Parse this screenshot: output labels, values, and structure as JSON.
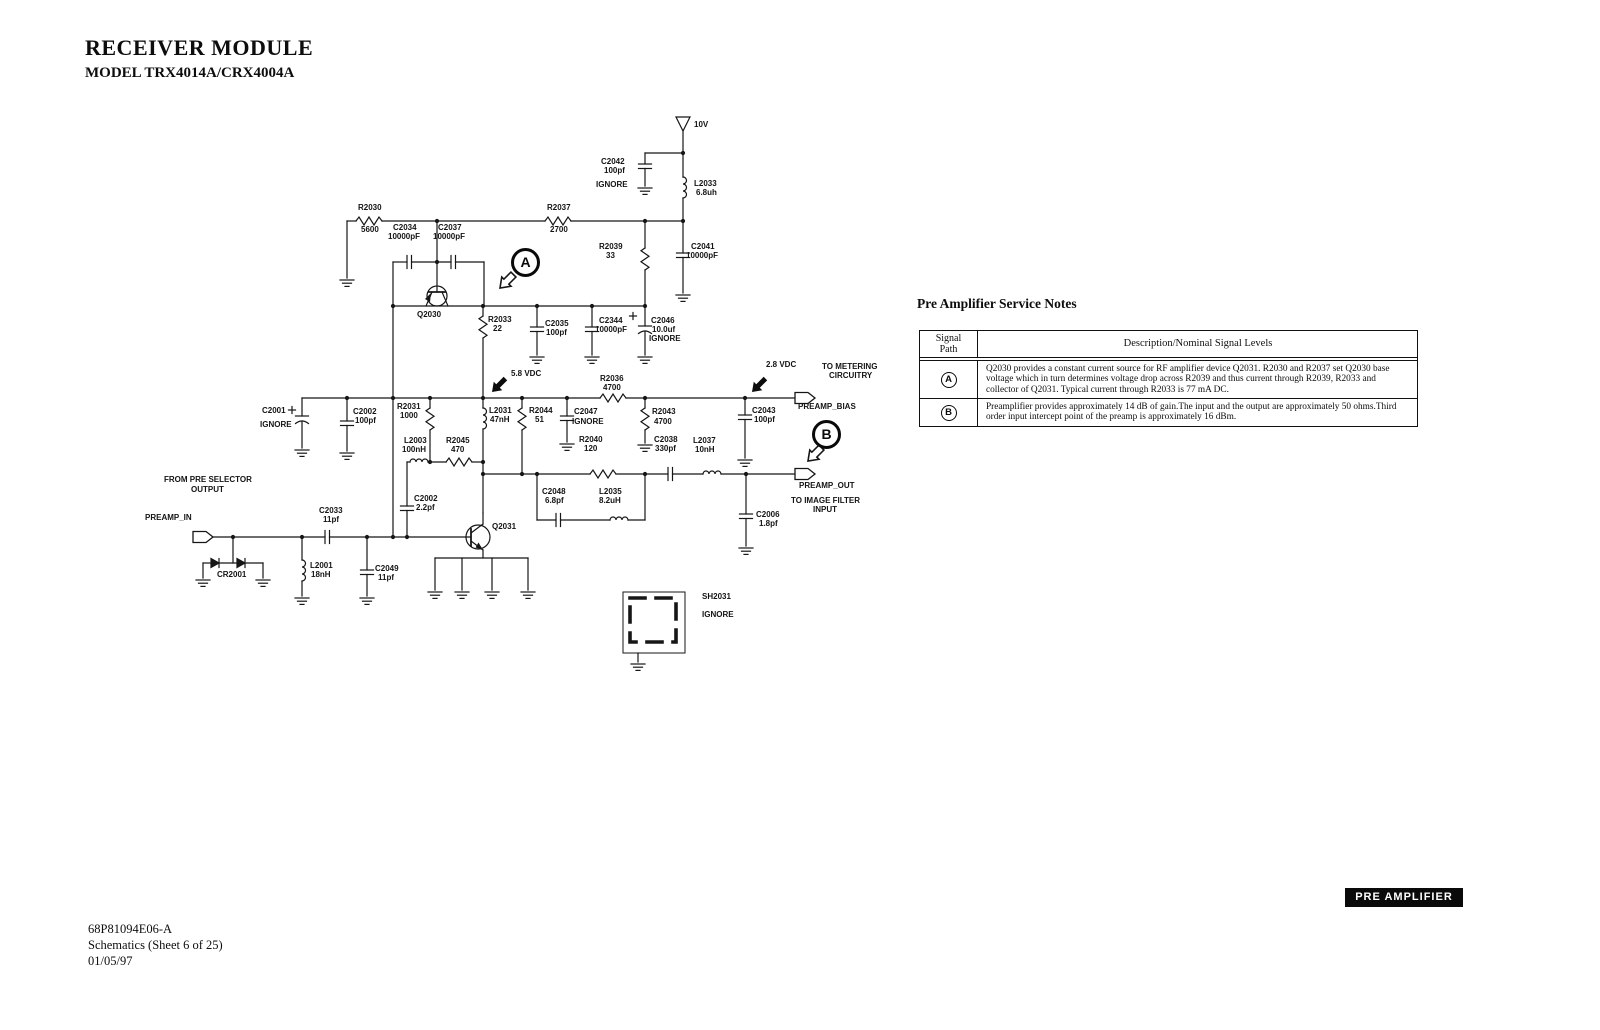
{
  "header": {
    "title": "RECEIVER MODULE",
    "model": "MODEL TRX4014A/CRX4004A"
  },
  "footer": {
    "part_number": "68P81094E06-A",
    "sheet": "Schematics (Sheet 6 of 25)",
    "date": "01/05/97"
  },
  "badge": {
    "label": "PRE AMPLIFIER"
  },
  "notes": {
    "title": "Pre Amplifier Service Notes",
    "col1_line1": "Signal",
    "col1_line2": "Path",
    "col2": "Description/Nominal Signal Levels",
    "rows": [
      {
        "path": "A",
        "text": "Q2030 provides a constant current source for RF amplifier device Q2031. R2030 and R2037 set Q2030 base voltage which in turn determines voltage drop across R2039 and thus current through R2039, R2033 and collector of Q2031. Typical current through R2033 is 77 mA DC."
      },
      {
        "path": "B",
        "text": "Preamplifier provides approximately 14 dB of gain.The input and the output are approximately 50 ohms.Third order input intercept point of the preamp is approximately 16 dBm."
      }
    ]
  },
  "labels": {
    "v10": "10V",
    "c2042_ref": "C2042",
    "c2042_val": "100pf",
    "c2042_note": "IGNORE",
    "l2033_ref": "L2033",
    "l2033_val": "6.8uh",
    "r2030_ref": "R2030",
    "r2030_val": "5600",
    "c2034_ref": "C2034",
    "c2034_val": "10000pF",
    "c2037_ref": "C2037",
    "c2037_val": "10000pF",
    "r2037_ref": "R2037",
    "r2037_val": "2700",
    "r2039_ref": "R2039",
    "r2039_val": "33",
    "c2041_ref": "C2041",
    "c2041_val": "10000pF",
    "q2030_ref": "Q2030",
    "r2033_ref": "R2033",
    "r2033_val": "22",
    "c2035_ref": "C2035",
    "c2035_val": "100pf",
    "c2344_ref": "C2344",
    "c2344_val": "10000pF",
    "c2046_ref": "C2046",
    "c2046_val": "10.0uf",
    "c2046_note": "IGNORE",
    "v58": "5.8 VDC",
    "v28": "2.8 VDC",
    "r2036_ref": "R2036",
    "r2036_val": "4700",
    "to_metering1": "TO METERING",
    "to_metering2": "CIRCUITRY",
    "preamp_bias": "PREAMP_BIAS",
    "c2001_ref": "C2001",
    "c2001_note": "IGNORE",
    "c2002a_ref": "C2002",
    "c2002a_val": "100pf",
    "r2031_ref": "R2031",
    "r2031_val": "1000",
    "l2003_ref": "L2003",
    "l2003_val": "100nH",
    "r2045_ref": "R2045",
    "r2045_val": "470",
    "l2031_ref": "L2031",
    "l2031_val": "47nH",
    "r2044_ref": "R2044",
    "r2044_val": "51",
    "c2047_ref": "C2047",
    "c2047_note": "IGNORE",
    "r2043_ref": "R2043",
    "r2043_val": "4700",
    "c2043_ref": "C2043",
    "c2043_val": "100pf",
    "r2040_ref": "R2040",
    "r2040_val": "120",
    "c2038_ref": "C2038",
    "c2038_val": "330pf",
    "l2037_ref": "L2037",
    "l2037_val": "10nH",
    "preamp_out": "PREAMP_OUT",
    "to_image1": "TO IMAGE FILTER",
    "to_image2": "INPUT",
    "c2048_ref": "C2048",
    "c2048_val": "6.8pf",
    "l2035_ref": "L2035",
    "l2035_val": "8.2uH",
    "c2006_ref": "C2006",
    "c2006_val": "1.8pf",
    "from_pre1": "FROM PRE SELECTOR",
    "from_pre2": "OUTPUT",
    "preamp_in": "PREAMP_IN",
    "c2033_ref": "C2033",
    "c2033_val": "11pf",
    "c2002b_ref": "C2002",
    "c2002b_val": "2.2pf",
    "cr2001_ref": "CR2001",
    "l2001_ref": "L2001",
    "l2001_val": "18nH",
    "c2049_ref": "C2049",
    "c2049_val": "11pf",
    "q2031_ref": "Q2031",
    "sh2031_ref": "SH2031",
    "sh2031_note": "IGNORE",
    "callout_a": "A",
    "callout_b": "B"
  }
}
